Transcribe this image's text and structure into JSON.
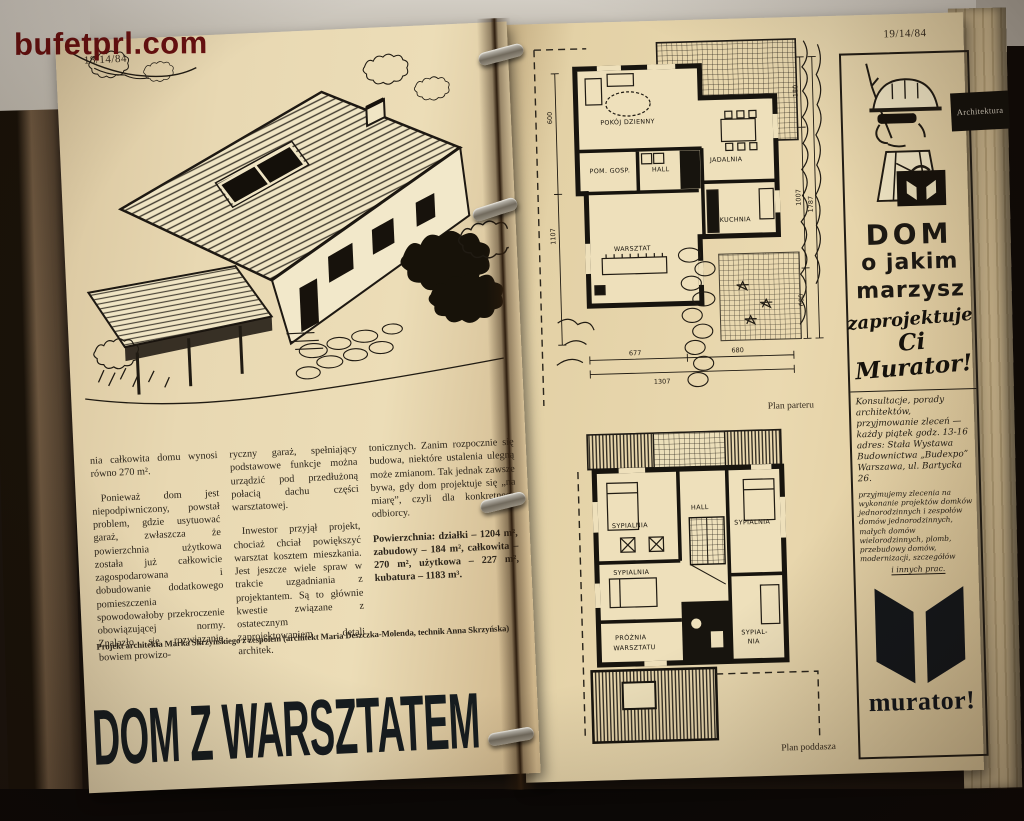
{
  "colors": {
    "paper": "#e8d7ae",
    "ink": "#211c14",
    "watermark_red": "#671010"
  },
  "watermark": "bufetprl.com",
  "left_page": {
    "page_number": "18/14/84",
    "article": {
      "col1_p1": "nia całkowita domu wynosi równo 270 m².",
      "col1_p2": "Ponieważ dom jest niepodpiwniczony, powstał problem, gdzie usytuować garaż, zwłaszcza że powierzchnia użytkowa została już całkowicie zagospodarowana i dobudowanie dodatkowego pomieszczenia spowodowałoby przekroczenie obowiązującej normy. Znalazło się rozwiązanie, bowiem prowizo-",
      "col2_p1": "ryczny garaż, spełniający podstawowe funkcje można urządzić pod przedłużoną połacią dachu części warsztatowej.",
      "col2_p2": "Inwestor przyjął projekt, chociaż chciał powiększyć warsztat kosztem mieszkania. Jest jeszcze wiele spraw w trakcie uzgadniania z projektantem. Są to głównie kwestie związane z ostatecznym zaprojektowaniem detali architek.",
      "col3_p1": "tonicznych. Zanim rozpocznie się budowa, niektóre ustalenia ulegną może zmianom. Tak jednak zawsze bywa, gdy dom projektuje się „na miarę”, czyli dla konkretnego odbiorcy.",
      "col3_p2": "Powierzchnia: działki – 1204 m², zabudowy – 184 m², całkowita – 270 m², użytkowa – 227 m², kubatura – 1183 m³."
    },
    "credit": "Projekt architekta Marka Skrzyńskiego z zespołem (architekt Maria Deszczka-Molenda, technik Anna Skrzyńska)",
    "headline": "DOM Z WARSZTATEM"
  },
  "right_page": {
    "page_number": "19/14/84",
    "section_tab": "Architektura",
    "plan_ground": {
      "caption": "Plan parteru",
      "rooms": [
        "POKÓJ DZIENNY",
        "JADALNIA",
        "POM. GOSP.",
        "HALL",
        "KUCHNIA",
        "WARSZTAT"
      ],
      "dims_bottom": [
        "677",
        "1307",
        "680"
      ],
      "dims_right": [
        "180",
        "1007",
        "1787",
        "600"
      ],
      "dims_left": [
        "600",
        "1107"
      ]
    },
    "plan_attic": {
      "caption": "Plan poddasza",
      "rooms": [
        "SYPIALNIA",
        "HALL",
        "SYPIALNIA",
        "SYPIALNIA",
        "SYPIAL-",
        "NIA",
        "PRÓŻNIA",
        "WARSZTATU"
      ]
    },
    "ad": {
      "line1": "DOM",
      "line2": "o jakim",
      "line3": "marzysz",
      "script1": "zaprojektuje",
      "script2": "Ci",
      "script3": "Murator!",
      "note1": "Konsultacje, porady architektów, przyjmowanie zleceń — każdy piątek godz. 13-16 adres: Stała Wystawa Budownictwa „Budexpo” Warszawa, ul. Bartycka 26.",
      "note2": "przyjmujemy zlecenia na wykonanie projektów domków jednorodzinnych i zespołów domów jednorodzinnych, małych domów wielorodzinnych, plomb, przebudowy domów, modernizacji, szczegółów",
      "note2_end": "i innych prac.",
      "logo_text": "murator!"
    }
  }
}
